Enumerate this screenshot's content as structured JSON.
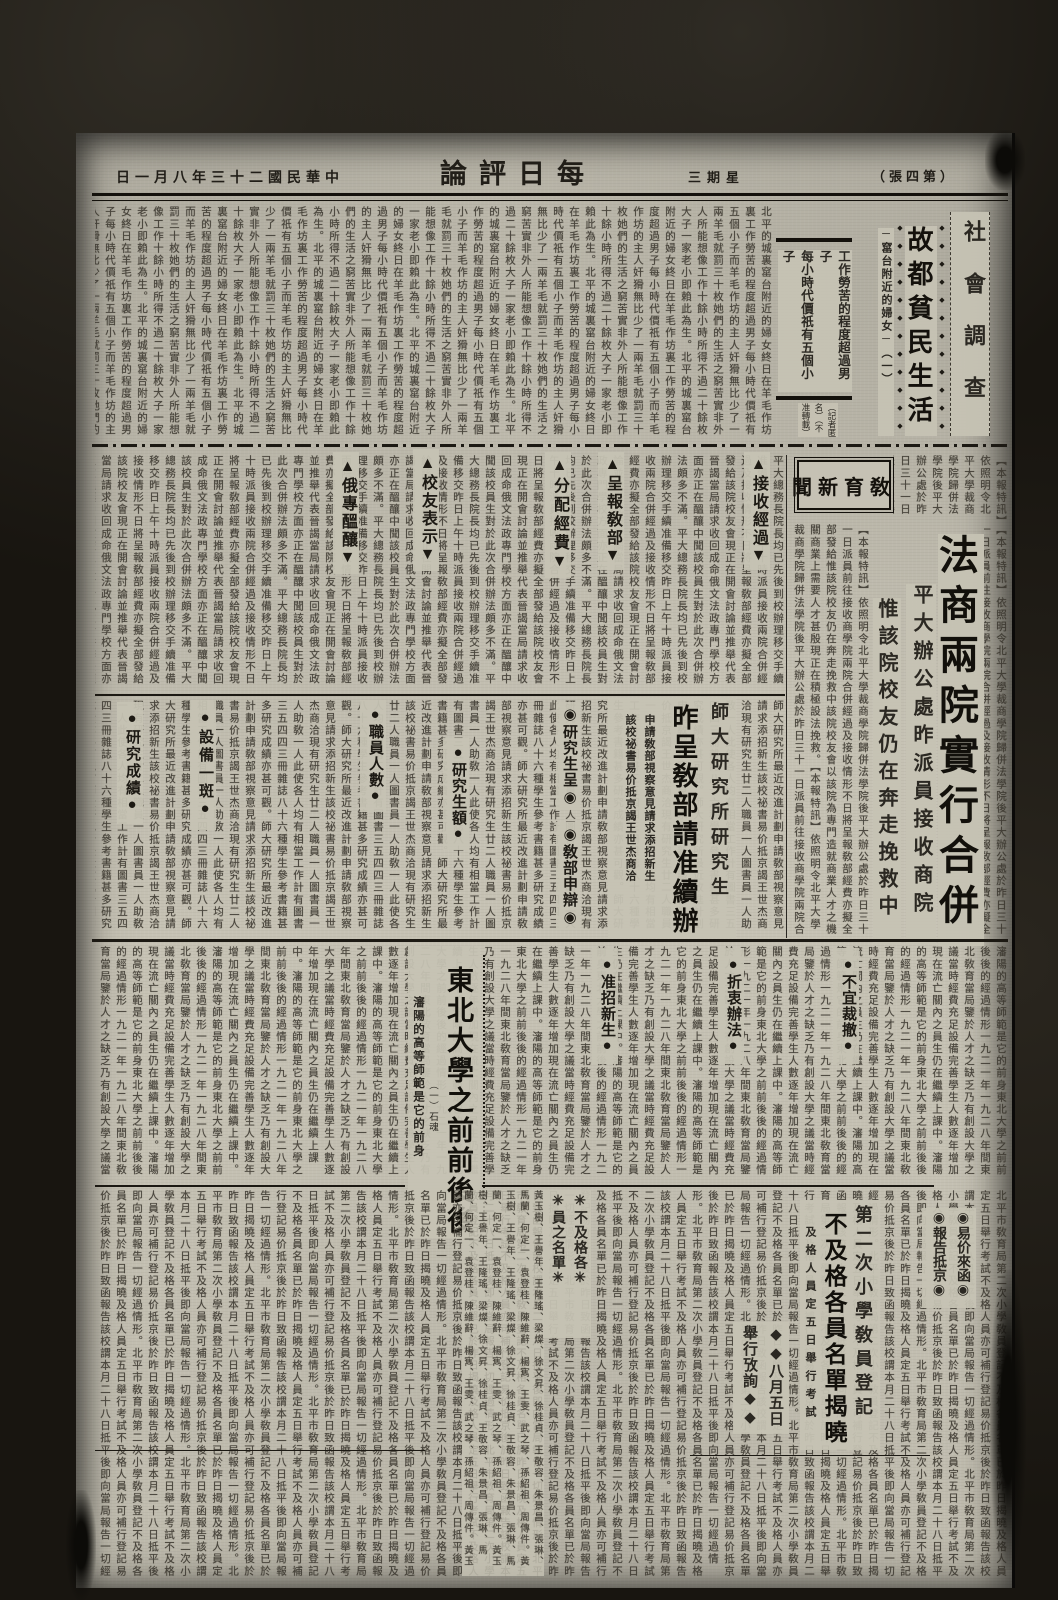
{
  "page": {
    "masthead": "每日評論",
    "date": "中華民國二十三年八月一日",
    "weekday": "星期三",
    "edition": "（第四張）"
  },
  "social": {
    "section_title": "社會調查",
    "headline": "故都貧民生活",
    "subtitle": "─窰台附近的婦女─（一）",
    "deck": "工作勞苦的程度超過男子\n每小時代價祇有五個小子\n羊毛作坊的主人奸猾無比\n少了一兩羊毛就罰三十枚",
    "byline": "（記者匿名）（不准轉載）"
  },
  "education": {
    "box_title": "敎育新聞",
    "lead": {
      "headline": "法商兩院實行合併",
      "subhead1": "平大辦公處昨派員接收商院",
      "subhead2": "惟該院校友仍在奔走挽救中"
    },
    "row1_headers": [
      "▲接收經過▼",
      "▲呈報敎部▼",
      "▲分配經費▼",
      "▲校友表示▼",
      "▲俄專醞釀▼"
    ],
    "row2_headers": [
      "◉研究生呈◉",
      "◉敎部申辯◉",
      "●職員人數●",
      "●研究生額●",
      "●設備一斑●",
      "●研究成績●"
    ],
    "shida": {
      "headline_small": "師大研究所研究生",
      "headline_large": "昨呈敎部請准續辦",
      "subhead1": "申請敎部視察意見請求添招新生",
      "subhead2": "該校祕書易价抵京謁王世杰商洽"
    }
  },
  "dongbei": {
    "headline": "東北大學之前前後後",
    "byline": "（一）石魂",
    "subtitle": "瀋陽的高等師範是它的前身",
    "headers": [
      "●不宜裁撤●",
      "●折衷辦法●",
      "●准招新生●"
    ]
  },
  "bottom": {
    "yijia_col1": "◉易价來函◉",
    "yijia_col2": "◉報告抵京◉",
    "teacher": {
      "headline_small": "第二次小學敎員登記",
      "headline_large": "不及格各員名單揭曉",
      "subhead": "及格人員定五日舉行考試"
    },
    "exam_col1": "◆◆八月五日",
    "exam_col2": "舉行攷詢◆◆",
    "namelist_col1": "✳不及格各✳",
    "namelist_col2": "✳員之名單✳"
  },
  "fillers": {
    "deco_diamonds": "◆◆◆◆◆◆◆◆◆◆◆◆",
    "social": "北平的城裏窰台附近的婦女終日在羊毛作坊裏工作勞苦的程度超過男子每小時代價祇有五個小子而羊毛作坊的主人奸猾無比少了一兩羊毛就罰三十枚她們的生活之窮苦實非外人所能想像工作十餘小時所得不過二十餘枚大子一家老小即賴此為生",
    "edu_lead": "【本報特訊】依照明令北平大學裁商學院歸併法學院後平大辦公處於昨日三十一日派員前往接收商學院兩院合併經過及接收情形不日將呈報敎部經費亦擬全部發給惟該院校友仍在奔走挽救中該院校友會以該院為專門造就商業人才之機關商業上需要人才甚殷現正在積極設法挽救",
    "edu_row": "平大總務長院長均已先後到校辦理移交手續准備移交昨日上午十時派員接收兩院合併經過及接收情形不日將呈報敎部經費亦擬全部發給該院校友會現正在開會討論並推舉代表晉謁當局請求收回成命俄文法政專門學校方面亦正在醞釀中聞該校員生對於此次合併辦法頗多不滿",
    "shida": "師大研究所最近改進計劃申請敎部視察意見請求添招新生該校祕書易价抵京謁王世杰商洽現有研究生廿二人職員一人圖書員一人助敎一人此使各人均有相當工作計有圖書三五四四三冊雜誌八十六種學生參考書籍甚多研究成績亦甚可觀",
    "dongbei": "瀋陽的高等師範是它的前身東北大學之前前後後的經過情形一九二一年一九二八年間東北敎育當局鑒於人才之缺乏乃有創設大學之議當時經費充足設備完善學生人數逐年增加現在流亡關內之員生仍在繼續上課中",
    "bottom": "北平市敎育局第二次小學敎員登記不及格各員名單已於昨日揭曉及格人員定五日舉行考試不及格人員亦可補行登記易价抵京後於昨日致函報告該校謂本月二十八日抵平後即向當局報告一切經過情形",
    "names": "黃玉樹、王譽年、王隆瑤、梁燦、徐文昇、徐桂貞、王敬容、朱景昌、張琳、馬蘭、何定一、袁登桂、陳維辭、楊寯、王雯、武之琴、孫紹祖、周傳件"
  }
}
